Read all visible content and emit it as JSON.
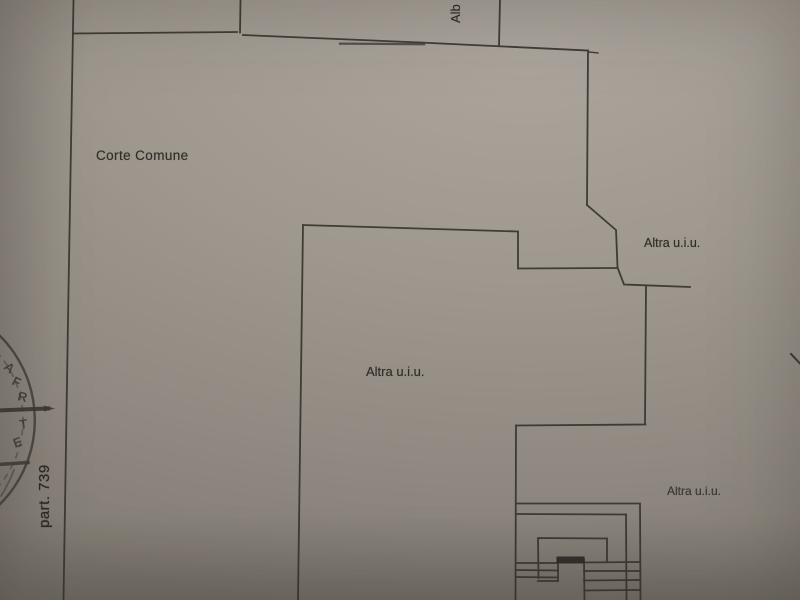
{
  "plan": {
    "labels": {
      "corte_comune": "Corte Comune",
      "altra_uiu_upper": "Altra u.i.u.",
      "altra_uiu_main": "Altra u.i.u.",
      "altra_uiu_lower": "Altra u.i.u.",
      "top_partial": "Alb",
      "parcel": "part. 739"
    },
    "stamp_letters": [
      "A",
      "F",
      "R",
      "T",
      "E"
    ],
    "colors": {
      "paper": "#9e988f",
      "paper_light": "#aba59d",
      "paper_dark": "#827c74",
      "line": "#38342e",
      "text": "#312d28",
      "stamp_ink": "#3f3a33"
    }
  }
}
